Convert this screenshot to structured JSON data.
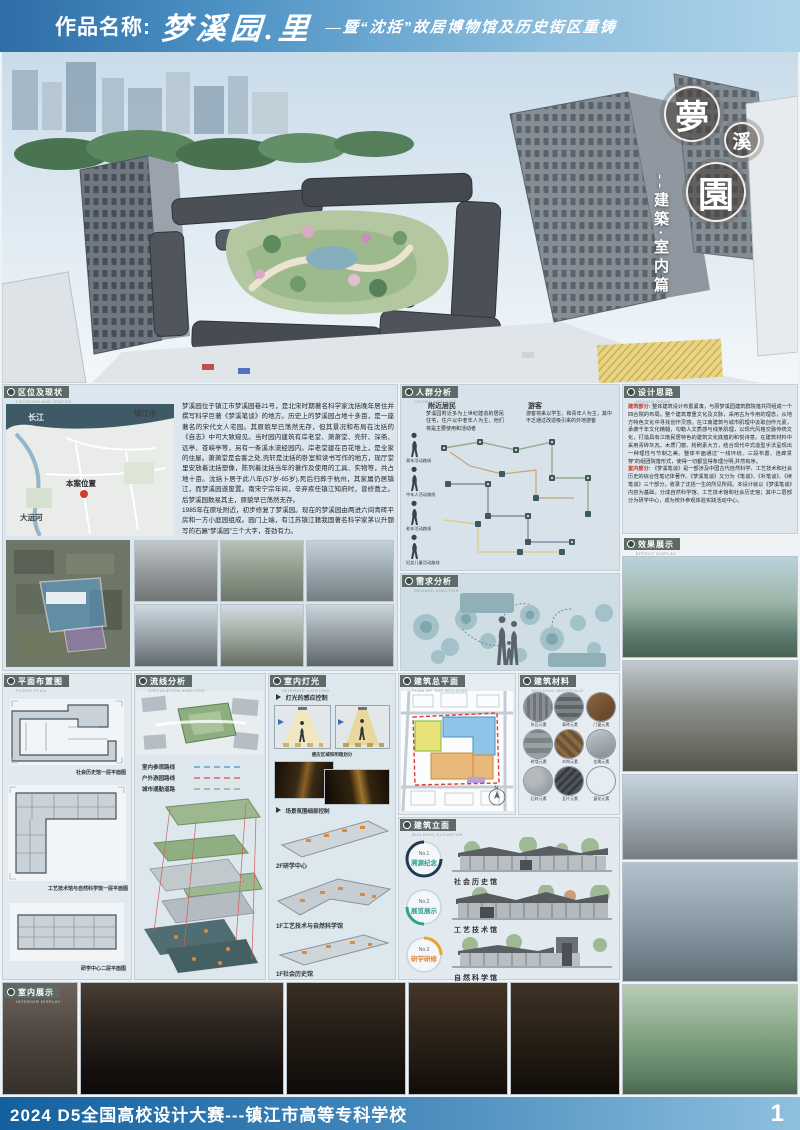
{
  "header": {
    "label": "作品名称:",
    "title": "梦溪园.里",
    "subtitle": "—暨“沈括”故居博物馆及历史街区重铸"
  },
  "hero": {
    "badges": [
      "夢",
      "溪",
      "園"
    ],
    "vertical_title": "--建築·室内篇"
  },
  "sections": {
    "location": {
      "zh": "区位及现状",
      "en": "LOCATION AND STATUS"
    },
    "crowd": {
      "zh": "人群分析",
      "en": "CROWD ANALYSIS"
    },
    "design": {
      "zh": "设计思路",
      "en": "DESIGN IDEAS"
    },
    "demand": {
      "zh": "需求分析",
      "en": "DEMAND ANALYSIS"
    },
    "effect": {
      "zh": "效果展示",
      "en": "EFFECT DISPLAY"
    },
    "floorplan": {
      "zh": "平面布置图",
      "en": "FLOOR PLAN"
    },
    "circulation": {
      "zh": "流线分析",
      "en": "CIRCULATION ANALYSIS"
    },
    "lighting": {
      "zh": "室内灯光",
      "en": "INTERIOR LIGHTING"
    },
    "siteplan": {
      "zh": "建筑总平面",
      "en": "PLAN OF THE BUILDING"
    },
    "materials": {
      "zh": "建筑材料",
      "en": "BUILDING MATERIALS"
    },
    "elevation": {
      "zh": "建筑立面",
      "en": "BUILDING ELEVATION"
    },
    "interior": {
      "zh": "室内展示",
      "en": "INTERIOR DISPLAY"
    }
  },
  "location": {
    "map": {
      "river": "长江",
      "city": "镇江市",
      "site": "本案位置",
      "canal": "大运河"
    },
    "para1": "梦溪园位于镇江市梦溪园巷21号，是北宋时期著名科学家沈括晚年居住并撰写科学巨著《梦溪笔谈》的地方。历史上的梦溪园占地十多亩，是一座著名的宋代文人宅园。其原貌早已荡然无存，但其景况和布局在沈括的《自志》中可大致窥见。当时园内建筑有岸老堂、萧萧堂、壳轩、深斋、远亭、苍峡亭等，另有一条溪水流经园内。岸老堂建在百花堆上，是全家的住屋。萧萧堂是会客之处,壳轩是沈括的卧室和读书写作的地方，现厅堂里安放着沈括塑像，陈列着沈括当年的著作及使用的工具、实物等，共占地十亩。沈括卜居于此八年(57岁-65岁),死后归葬于杭州，其家属仍居镇江，而梦溪园遂废置。南宋宁宗年间，辛弃疾任镇江知府时，曾修葺之。后梦溪园数易其主，原貌早已荡然无存。",
    "para2": "1985年在原址附近，初步修复了梦溪园。现在的梦溪园由两进六间青砖平房和一方小庭园组成。园门上端，有江苏镇江籍我国著名科学家茅以升题写的石匾“梦溪园”三个大字，苍劲有力。"
  },
  "crowd": {
    "residents_title": "附近居民",
    "residents_text": "梦溪园附近多为上世纪建造的居民住宅，住户以中老年人为主，他们将是主要使用和活动者",
    "visitors_title": "游客",
    "visitors_text": "游客将来以学生、和青年人为主，其中不乏通过改造吸引来的外地游客",
    "routes": [
      "青年活动路线",
      "中年人活动路线",
      "老年活动路线",
      "妇女儿童活动路线"
    ]
  },
  "design": {
    "arch_label": "建筑部分:",
    "arch_text": "整体建筑设计布置紧凑，与原梦溪园建筑群院落共同组成一个四合院的布局。整个建筑尊重文化及文脉，采用古为今用的理念，从地方特色文化中寻找创作灵感。在江南建筑与城市肌理中汲取创作元素，承袭千年文化精髓，勾勒人文质感与线条肌理，以现代风格交融传统文化，打造具有江南民居特色的建筑文化底蕴的和悦诗意。在建筑材料中采用青砖灰瓦、木质门窗、粉刷素大方，结合现代中式造型手法呈现出一种理性与节制之美。整体平面通过“一线环绕、三段布置、连廊贯穿”的组团院落形式，使得一切都显得条理分明,井然有序。",
    "interior_label": "室内部分:",
    "interior_text": "《梦溪笔谈》是一部涉及中国古代自然科学、工艺技术和社会历史的综合性笔记体著作。《梦溪笔谈》又分为《笔谈》、《补笔谈》、《续笔谈》三个部分，收录了沈括一生的所见所闻。本设计就以《梦溪笔谈》内容为基础，分成自然科学馆、工艺技术馆和社会历史馆；其中二层部分为研学中心，成为校外参观体验实践活动中心。"
  },
  "floorplans": {
    "captions": [
      "社会历史馆一层平面图",
      "工艺技术馆与自然科学馆一层平面图",
      "研学中心二层平面图"
    ]
  },
  "circulation": {
    "legend": [
      {
        "label": "室内参观路线",
        "color": "#7fb3d5"
      },
      {
        "label": "户外游园路线",
        "color": "#e08585"
      },
      {
        "label": "城市通勤道路",
        "color": "#9bc49b"
      }
    ]
  },
  "lighting": {
    "item1": "灯光的感应控制",
    "caption1": "感应区域和明暗划分",
    "item2": "场景氛围细部控制",
    "plans": [
      "2F研学中心",
      "1F工艺技术与自然科学馆",
      "1F社会历史馆"
    ]
  },
  "materials": {
    "labels": [
      "灰瓦元素",
      "青砖元素",
      "门窗元素",
      "砖墙元素",
      "木构元素",
      "金属元素",
      "石材元素",
      "瓦片元素",
      "窗花元素"
    ]
  },
  "siteplan": {
    "compass": "N"
  },
  "elevations": {
    "items": [
      {
        "no": "No.1",
        "tag": "溯源纪念",
        "name": "社会历史馆",
        "color": "#1f3a53"
      },
      {
        "no": "No.2",
        "tag": "展览展示",
        "name": "工艺技术馆",
        "color": "#2f9e8f"
      },
      {
        "no": "No.3",
        "tag": "研学研修",
        "name": "自然科学馆",
        "color": "#e3a72f"
      }
    ]
  },
  "footer": {
    "text": "2024 D5全国高校设计大赛---镇江市高等专科学校",
    "page": "1"
  }
}
